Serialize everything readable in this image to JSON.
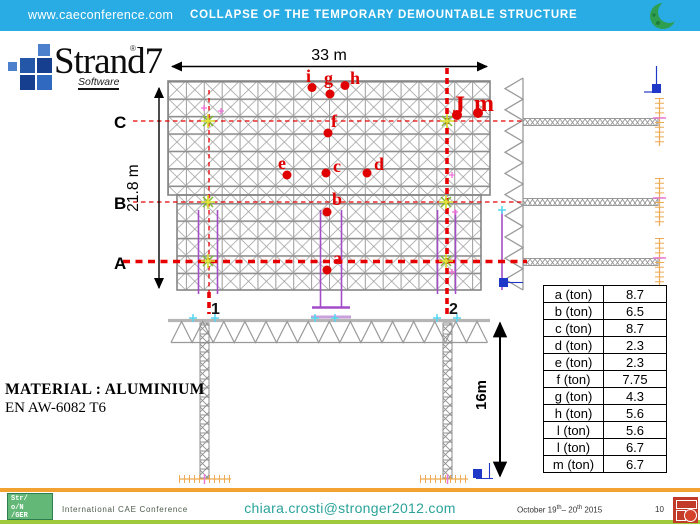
{
  "banner": {
    "site": "www.caeconference.com",
    "title": "COLLAPSE OF THE TEMPORARY DEMOUNTABLE STRUCTURE"
  },
  "logo": {
    "brand": "Strand7",
    "reg": "®",
    "sub": "Software"
  },
  "diagram": {
    "dims": {
      "width": "33 m",
      "height": "21.8 m",
      "column": "16m"
    },
    "levels": [
      {
        "label": "C"
      },
      {
        "label": "B"
      },
      {
        "label": "A"
      }
    ],
    "axes": [
      {
        "label": "1"
      },
      {
        "label": "2"
      }
    ],
    "points": [
      {
        "label": "i"
      },
      {
        "label": "g"
      },
      {
        "label": "h"
      },
      {
        "label": "J"
      },
      {
        "label": "m"
      },
      {
        "label": "f"
      },
      {
        "label": "e"
      },
      {
        "label": "c"
      },
      {
        "label": "d"
      },
      {
        "label": "b"
      },
      {
        "label": "a"
      }
    ]
  },
  "material": {
    "line1": "MATERIAL : ALUMINIUM",
    "line2": "EN AW-6082 T6"
  },
  "table": {
    "rows": [
      {
        "label": "a (ton)",
        "value": "8.7"
      },
      {
        "label": "b (ton)",
        "value": "6.5"
      },
      {
        "label": "c (ton)",
        "value": "8.7"
      },
      {
        "label": "d (ton)",
        "value": "2.3"
      },
      {
        "label": "e (ton)",
        "value": "2.3"
      },
      {
        "label": "f (ton)",
        "value": "7.75"
      },
      {
        "label": "g (ton)",
        "value": "4.3"
      },
      {
        "label": "h (ton)",
        "value": "5.6"
      },
      {
        "label": "l (ton)",
        "value": "5.6"
      },
      {
        "label": "l (ton)",
        "value": "6.7"
      },
      {
        "label": "m (ton)",
        "value": "6.7"
      }
    ]
  },
  "footer": {
    "badge_lines": [
      "Str/",
      "o/N",
      "/GER"
    ],
    "conference": "International CAE Conference",
    "email": "chiara.crosti@stronger2012.com",
    "date_prefix": "October 19",
    "date_sup1": "th",
    "date_mid": "– 20",
    "date_sup2": "th",
    "date_year": " 2015",
    "page": "10"
  },
  "colors": {
    "banner_cyan": "#29ace3",
    "rule_orange": "#f2a230",
    "rule_green": "#9dc93b",
    "marker_red": "#e00000",
    "column_purple": "#a24cc8",
    "support_orange": "#ecaa52",
    "node_blue": "#2038c8",
    "email_teal": "#2ba39a",
    "truss_gray": "#909090"
  }
}
